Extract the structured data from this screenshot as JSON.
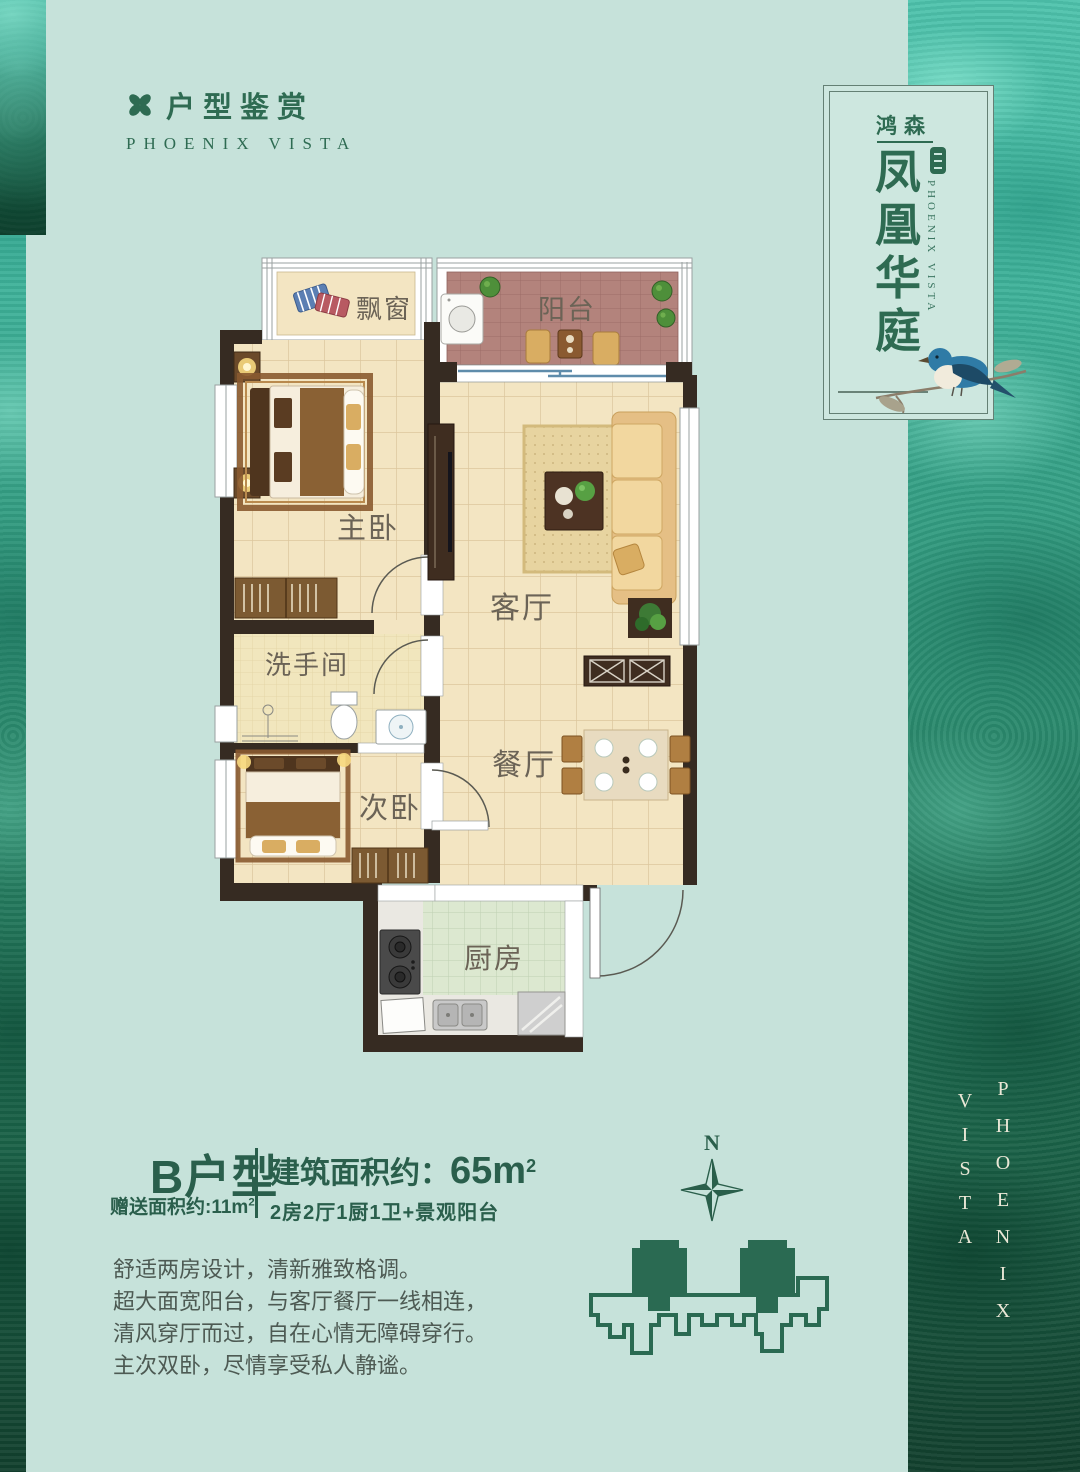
{
  "header": {
    "title": "户型鉴赏",
    "subtitle": "PHOENIX VISTA"
  },
  "badge": {
    "developer": "鸿森",
    "name_chars": [
      "凤",
      "凰",
      "华",
      "庭"
    ],
    "subtitle": "PHOENIX VISTA"
  },
  "plan": {
    "bay_window": "飘窗",
    "balcony": "阳台",
    "master_bedroom": "主卧",
    "living_room": "客厅",
    "bathroom": "洗手间",
    "dining_room": "餐厅",
    "second_bedroom": "次卧",
    "kitchen": "厨房"
  },
  "info": {
    "unit_type": "B户型",
    "bonus_text": "赠送面积约:11m",
    "bonus_sup": "2",
    "area_cn": "建筑面积约：",
    "area_num": "65m",
    "area_sup": "2",
    "config": "2房2厅1厨1卫+景观阳台"
  },
  "description": {
    "lines": [
      "舒适两房设计，清新雅致格调。",
      "超大面宽阳台，与客厅餐厅一线相连，",
      "清风穿厅而过，自在心情无障碍穿行。",
      "主次双卧，尽情享受私人静谧。"
    ]
  },
  "compass": {
    "north": "N"
  },
  "side_brand": {
    "word1": "PHOENIX",
    "word2": "VISTA"
  },
  "colors": {
    "background": "#c6e2da",
    "brand_green": "#2e6b52",
    "info_green": "#2a5f4c",
    "wall_dark": "#362b22",
    "floor_cream": "#f3e5c2",
    "balcony_brick": "#b3837c",
    "kitchen_tile": "#dce8d0",
    "label_gray": "#6b6356"
  }
}
